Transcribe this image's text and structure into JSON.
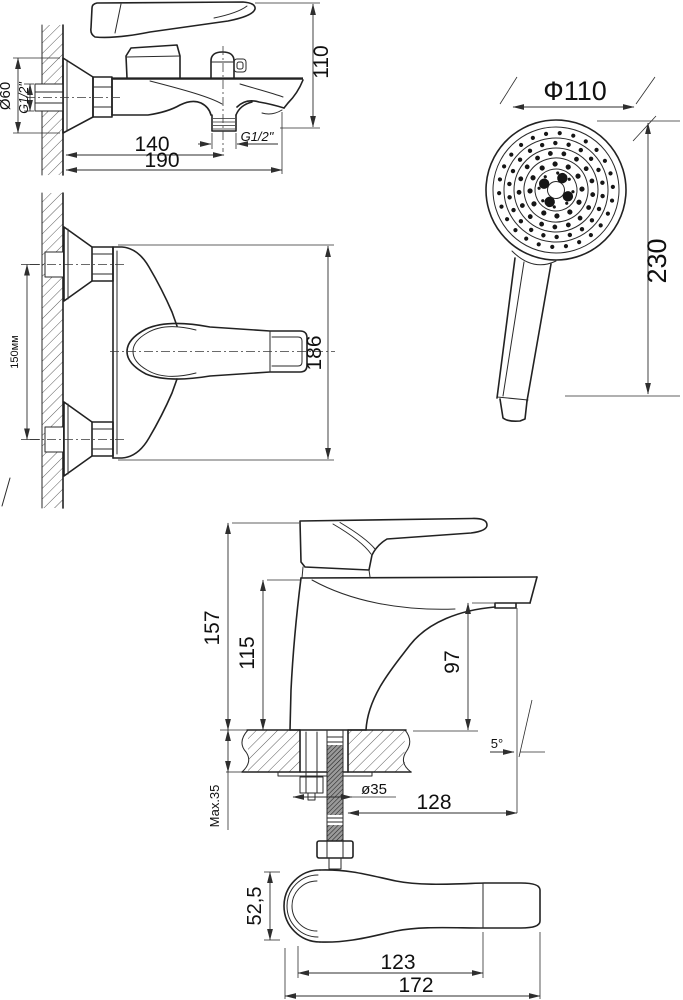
{
  "views": {
    "bath_mixer_side": {
      "flange": "Ø60",
      "wall_thread": "G1/2\"",
      "height": "110",
      "reach_outlet": "140",
      "reach_total": "190",
      "outlet_thread": "G1/2\""
    },
    "bath_mixer_top": {
      "centers": "150мм",
      "width": "186"
    },
    "hand_shower": {
      "head_diameter": "Ф110",
      "length": "230"
    },
    "basin_mixer_side": {
      "total_height": "157",
      "body_height": "115",
      "spout_height": "97",
      "angle": "5°",
      "hole": "ø35",
      "deck_max": "Мах.35",
      "reach": "128"
    },
    "basin_mixer_top": {
      "width": "52,5",
      "spout": "123",
      "length": "172"
    }
  },
  "colors": {
    "line": "#222222",
    "dimension": "#2e2e2e",
    "text": "#101010",
    "background": "#ffffff"
  }
}
